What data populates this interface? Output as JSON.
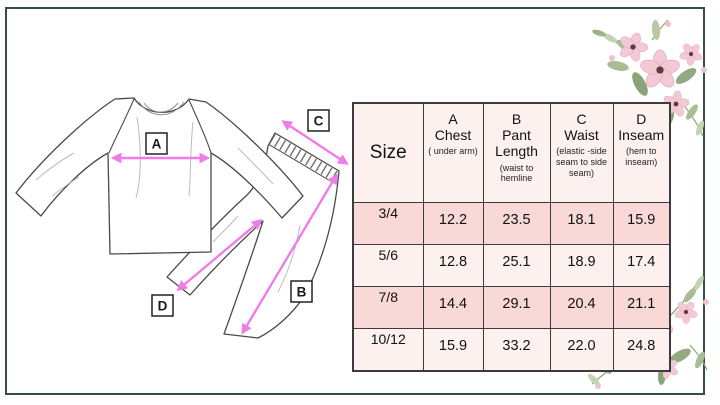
{
  "colors": {
    "frame_green": "#315046",
    "arrow_pink": "#ee7de8",
    "row_pink": "#f8d9d7",
    "row_light": "#fdf1f0",
    "sketch_line": "#4a4a4a",
    "flower_petal": "#f2c9d5",
    "flower_center": "#63393f",
    "leaf_green": "#8ca37a"
  },
  "diagram": {
    "labels": {
      "a": "A",
      "b": "B",
      "c": "C",
      "d": "D"
    }
  },
  "size_chart": {
    "size_header": "Size",
    "columns": [
      {
        "letter": "A",
        "name": "Chest",
        "note": "( under arm)"
      },
      {
        "letter": "B",
        "name": "Pant Length",
        "note": "(waist to hemline"
      },
      {
        "letter": "C",
        "name": "Waist",
        "note": "(elastic -side seam to side seam)"
      },
      {
        "letter": "D",
        "name": "Inseam",
        "note": "(hem to inseam)"
      }
    ],
    "rows": [
      {
        "size": "3/4",
        "chest": "12.2",
        "pant_length": "23.5",
        "waist": "18.1",
        "inseam": "15.9"
      },
      {
        "size": "5/6",
        "chest": "12.8",
        "pant_length": "25.1",
        "waist": "18.9",
        "inseam": "17.4"
      },
      {
        "size": "7/8",
        "chest": "14.4",
        "pant_length": "29.1",
        "waist": "20.4",
        "inseam": "21.1"
      },
      {
        "size": "10/12",
        "chest": "15.9",
        "pant_length": "33.2",
        "waist": "22.0",
        "inseam": "24.8"
      }
    ]
  }
}
